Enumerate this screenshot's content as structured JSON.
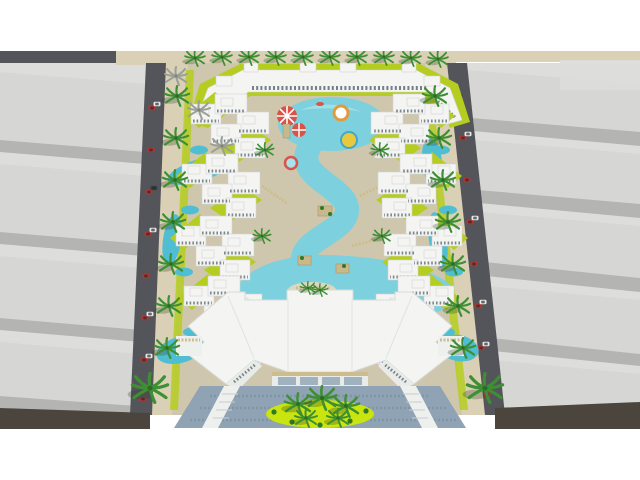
{
  "image": {
    "kind": "3d-architectural-aerial-render",
    "subject": "Bird's-eye rendering of a resort residential compound with zig-zag white apartment blocks around a winding turquoise lagoon pool, a kids aqua-park at the top, a large star-shaped white clubhouse at the bottom, palm-lined roads with cars on both sides, and plain grey massing blocks of the surrounding city"
  },
  "palette": {
    "white_bg": "#ffffff",
    "sand": "#d9d0b5",
    "sand_light": "#e2dac2",
    "walkway": "#cfc7ad",
    "walkway_light": "#ded7c0",
    "road_dark": "#54555a",
    "road_bottom": "#4b453d",
    "massing_top": "#d6d6d4",
    "massing_side": "#b4b4b2",
    "massing_street": "#dddddb",
    "lawn": "#b5cc21",
    "lawn_bright": "#c9e40e",
    "pool": "#7dd0dd",
    "pool_deep": "#4fbdd2",
    "pool_light": "#a8e2ea",
    "building_white": "#f4f5f3",
    "window": "#5c6a75",
    "glass": "#9fb2bd",
    "awning_tan": "#cdbd8e",
    "plaza_blue": "#8fa3b4",
    "plaza_dark": "#76909f",
    "palm_green": "#3e8f33",
    "palm_dark": "#2e6b26",
    "palm_gray": "#9aa098",
    "car_red": "#b5342e",
    "car_white": "#e8e8e8",
    "car_dark": "#3a3f46",
    "canopy_red": "#d95348",
    "float_orange": "#e29a3e",
    "float_yellow": "#e8c93e"
  },
  "scene": {
    "margins": "white bands above y=51 and below y=429",
    "regions": [
      "left city massing blocks",
      "right city massing blocks",
      "left road with traffic",
      "right road with traffic",
      "top-left road",
      "bottom corner roads",
      "beach sand strip along the top",
      "resort grounds with beige walkways and lime lawns",
      "U-shaped apartment building at top",
      "five zig-zag apartment clusters per side",
      "central winding lagoon pool with lazy river",
      "kids aqua-park with red-white canopies",
      "pool floats (orange ring, yellow disc)",
      "large white clubhouse with glass storefronts and awnings",
      "blue-grey mosaic entrance plaza with bright lawn and palms"
    ],
    "approx_counts": {
      "palm_trees": 42,
      "gray_palms": 3,
      "cars": 25,
      "apartment_clusters": 10,
      "pools_and_ponds": 12
    }
  }
}
